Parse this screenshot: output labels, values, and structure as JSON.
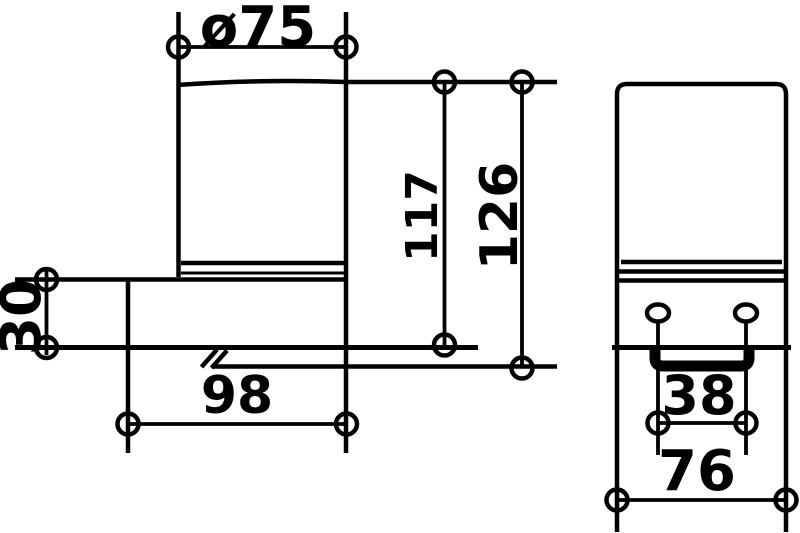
{
  "meta": {
    "drawing_type": "technical-dimension-drawing",
    "subject": "wall-mounted tumbler holder, two orthographic views",
    "background_color": "#ffffff",
    "line_color": "#000000"
  },
  "views": {
    "side": {
      "name": "side view (left)"
    },
    "front": {
      "name": "front view (right)"
    }
  },
  "dims": {
    "cup_diameter": {
      "label": "ø75",
      "value": 75,
      "kind": "diameter"
    },
    "cup_height": {
      "label": "117",
      "value": 117,
      "kind": "vertical"
    },
    "total_height": {
      "label": "126",
      "value": 126,
      "kind": "vertical"
    },
    "bracket_height": {
      "label": "30",
      "value": 30,
      "kind": "vertical"
    },
    "bracket_depth": {
      "label": "98",
      "value": 98,
      "kind": "horizontal"
    },
    "slot_spacing": {
      "label": "38",
      "value": 38,
      "kind": "horizontal"
    },
    "bracket_width": {
      "label": "76",
      "value": 76,
      "kind": "horizontal"
    }
  }
}
